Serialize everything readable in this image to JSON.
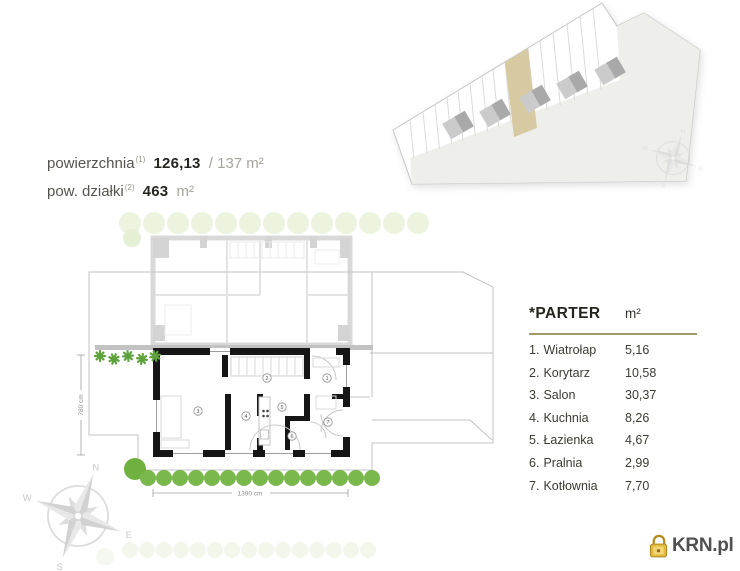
{
  "header": {
    "area_label": "powierzchnia",
    "area_sup": "(1)",
    "area_value": "126,13",
    "area_alt": "/ 137 m²",
    "plot_label": "pow. działki",
    "plot_sup": "(2)",
    "plot_value": "463",
    "plot_unit": "m²"
  },
  "legend": {
    "title": "*PARTER",
    "unit": "m²",
    "rows": [
      {
        "num": "1.",
        "name": "Wiatrołap",
        "area": "5,16"
      },
      {
        "num": "2.",
        "name": "Korytarz",
        "area": "10,58"
      },
      {
        "num": "3.",
        "name": "Salon",
        "area": "30,37"
      },
      {
        "num": "4.",
        "name": "Kuchnia",
        "area": "8,26"
      },
      {
        "num": "5.",
        "name": "Łazienka",
        "area": "4,67"
      },
      {
        "num": "6.",
        "name": "Pralnia",
        "area": "2,99"
      },
      {
        "num": "7.",
        "name": "Kotłownia",
        "area": "7,70"
      }
    ]
  },
  "plan": {
    "width_label": "1390 cm",
    "height_label": "780 cm",
    "room_numbers": [
      "1",
      "2",
      "3",
      "4",
      "5",
      "6",
      "7"
    ]
  },
  "compass": {
    "n": "N",
    "e": "E",
    "s": "S",
    "w": "W"
  },
  "logo": {
    "text": "KRN.pl"
  },
  "colors": {
    "highlight_tan": "#d7c9a2",
    "tree_green": "#7ab74c",
    "legend_rule": "#a39a6c",
    "logo_gold": "#e3b93d",
    "wall_black": "#161616"
  }
}
